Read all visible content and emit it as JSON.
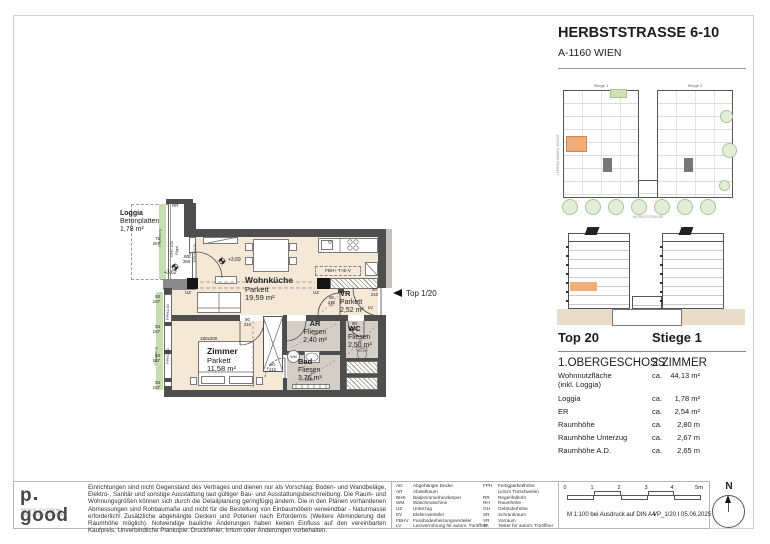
{
  "sheet": {
    "title": "HERBSTSTRASSE 6-10",
    "subtitle": "A-1160 WIEN"
  },
  "key_plan": {
    "stiege1": "Stiege 1",
    "stiege2": "Stiege 2",
    "street_bottom": "HERBSTSTRASSE",
    "street_left": "LORENZ-MANDL-GASSE"
  },
  "unit_info": {
    "top": "Top 20",
    "stiege": "Stiege 1",
    "floor": "1.OBERGESCHOSS",
    "rooms": "2 ZIMMER",
    "rows": [
      {
        "label": "Wohnnutzfläche",
        "label2": "(inkl. Loggia)",
        "ca": "ca.",
        "value": "44,13 m²"
      },
      {
        "label": "Loggia",
        "ca": "ca.",
        "value": "1,78 m²"
      },
      {
        "label": "ER",
        "ca": "ca.",
        "value": "2,54 m²"
      },
      {
        "label": "Raumhöhe",
        "ca": "ca.",
        "value": "2,80 m"
      },
      {
        "label": "Raumhöhe Unterzug",
        "ca": "ca.",
        "value": "2,67 m"
      },
      {
        "label": "Raumhöhe A.D.",
        "ca": "ca.",
        "value": "2,65 m"
      }
    ]
  },
  "plan": {
    "marker": "Top 1/20",
    "loggia": {
      "name": "Loggia",
      "floor": "Betonplatten",
      "area": "1,78 m²"
    },
    "rooms": {
      "wohnkueche": {
        "name": "Wohnküche",
        "floor": "Parkett",
        "area": "19,59 m²"
      },
      "zimmer": {
        "name": "Zimmer",
        "floor": "Parkett",
        "area": "11,58 m²"
      },
      "ar": {
        "name": "AR",
        "floor": "Fliesen",
        "area": "2,40 m²"
      },
      "bad": {
        "name": "Bad",
        "floor": "Fliesen",
        "area": "3,76 m²"
      },
      "wc": {
        "name": "WC",
        "floor": "Fliesen",
        "area": "2,50 m²"
      },
      "vr": {
        "name": "VR",
        "floor": "Parkett",
        "area": "2,52 m²"
      }
    },
    "labels": {
      "uz": "UZ",
      "fbh": "FBH+ T+E-V",
      "fix1": "Fix",
      "fix2": "FPH±0,00",
      "fph": "FPH1,00",
      "rr": "RR",
      "gh": "GH= 102",
      "rigol": "Rigol",
      "pflanztrog": "Pflanztrog",
      "bhk": "BHK",
      "lv": "LV",
      "wm": "WM",
      "ad": "AD",
      "bed": "180x200",
      "elev_main": "+3,69",
      "elev_loggia": "+3,62"
    },
    "dims": {
      "loggia": {
        "t": "75",
        "b": "267"
      },
      "window": {
        "t": "93",
        "b": "167"
      }
    },
    "doors": {
      "balcony": {
        "t": "80",
        "b": "259"
      },
      "room": {
        "t": "80",
        "b": "210"
      },
      "entry": {
        "t": "90",
        "b": "210"
      }
    }
  },
  "footer": {
    "logo": {
      "p": "p",
      "good": "good",
      "sub1": "PRISCHL GOODMANN",
      "sub2": "ARCHITEKTEN ZT GMBH"
    },
    "disclaimer": "Einrichtungen sind nicht Gegenstand des Vertrages und dienen nur als Vorschlag. Boden- und Wandbeläge, Elektro-, Sanitär und sonstige Ausstattung laut gültiger Bau- und Ausstattungsbeschreibung. Die Raum- und Wohnungsgrößen können sich durch die Detailplanung geringfügig ändern. Die in den Plänen vorhandenen Abmessungen sind Rohbaumaße und nicht für die Bestellung von Einbaumöbeln verwendbar - Naturmasse erforderlich! Zusätzliche abgehängte Decken und Poterien nach Erfordernis (Weitere Abminderung der Raumhöhe möglich). Notwendige bauliche Änderungen haben keinen Einfluss auf den vereinbarten Kaufpreis. Unverbindliche Plankopie. Druckfehler, Irrtum oder Änderungen vorbehalten.",
    "legend_col1": [
      {
        "k": "AD",
        "v": "Abgehängte Decke"
      },
      {
        "k": "AR",
        "v": "Abstellraum"
      },
      {
        "k": "BHK",
        "v": "Badezimmerheizkörper"
      },
      {
        "k": "WM",
        "v": "Waschmaschine"
      },
      {
        "k": "UZ",
        "v": "Unterzug"
      },
      {
        "k": "EV",
        "v": "Elektroverteiler"
      },
      {
        "k": "FBHV",
        "v": "Fussbodenheizungsverteiler"
      },
      {
        "k": "LV",
        "v": "Leerverrohrung für autom. Türöffner"
      }
    ],
    "legend_col2": [
      {
        "k": "FPH",
        "v": "Fertigparketthöhe"
      },
      {
        "k": "",
        "v": "(±3cm Türschwelle)"
      },
      {
        "k": "RR",
        "v": "Regenfallrohr"
      },
      {
        "k": "RH",
        "v": "Raumhöhe"
      },
      {
        "k": "GH",
        "v": "Geländerhöhe"
      },
      {
        "k": "SR",
        "v": "Schrankraum"
      },
      {
        "k": "VR",
        "v": "Vorraum"
      },
      {
        "k": "TA",
        "v": "Taster für autom. Türöffner"
      }
    ],
    "scale": {
      "ticks": [
        "0",
        "1",
        "2",
        "3",
        "4",
        "5m"
      ],
      "note": "M 1:100 bei Ausdruck auf DIN A4",
      "ref": "VP_1/20 I 05.06.2025"
    },
    "north": "N"
  }
}
